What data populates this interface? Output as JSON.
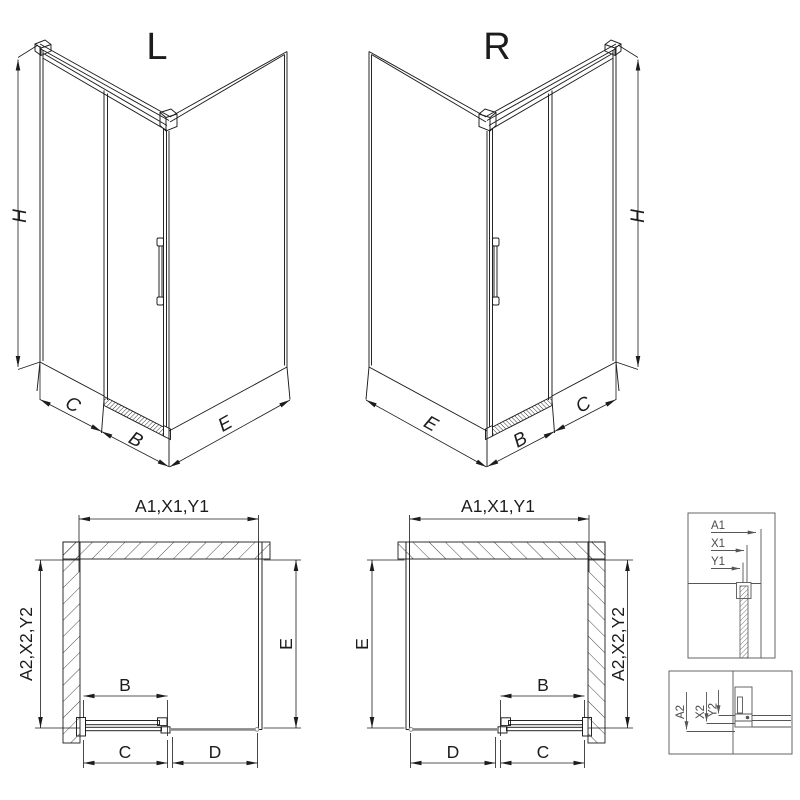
{
  "iso_left": {
    "title": "L",
    "height": "H",
    "front_fixed": "C",
    "front_door": "B",
    "side": "E"
  },
  "iso_right": {
    "title": "R",
    "height": "H",
    "front_fixed": "C",
    "front_door": "B",
    "side": "E"
  },
  "plan_left": {
    "top": "A1,X1,Y1",
    "wall": "A2,X2,Y2",
    "depth": "E",
    "door": "B",
    "bottom_near": "C",
    "bottom_far": "D"
  },
  "plan_right": {
    "top": "A1,X1,Y1",
    "wall": "A2,X2,Y2",
    "depth": "E",
    "door": "B",
    "bottom_near": "C",
    "bottom_far": "D"
  },
  "detail_width": {
    "l1": "A1",
    "l2": "X1",
    "l3": "Y1"
  },
  "detail_depth": {
    "l1": "A2",
    "l2": "X2",
    "l3": "Y2"
  },
  "colors": {
    "line": "#1c1c1c",
    "rail_gray": "#8a8a8a",
    "detail_line": "#565656",
    "background": "#ffffff"
  }
}
